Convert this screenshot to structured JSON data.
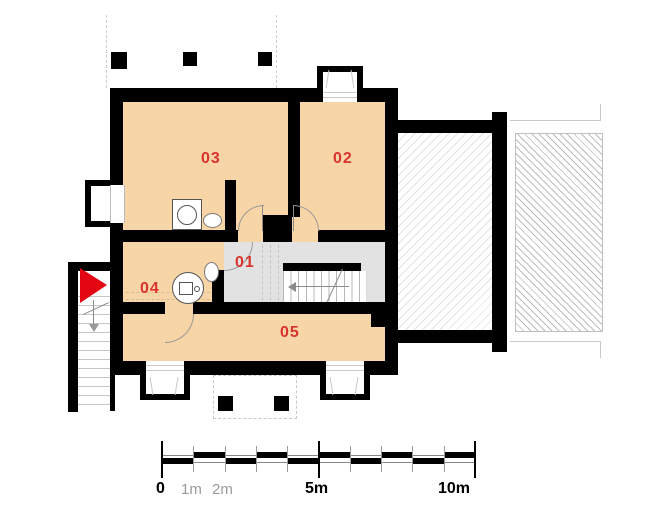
{
  "plan": {
    "kind": "architectural-floor-plan",
    "rooms": [
      {
        "id": "01",
        "label": "01",
        "note": "hall-with-stairs"
      },
      {
        "id": "02",
        "label": "02"
      },
      {
        "id": "03",
        "label": "03"
      },
      {
        "id": "04",
        "label": "04"
      },
      {
        "id": "05",
        "label": "05"
      }
    ],
    "fixtures": [
      "washing-machine-icon",
      "sink-icon",
      "toilet-icon",
      "interior-stairs-icon",
      "exterior-stairs-icon",
      "entrance-arrow-icon",
      "chimney-icon",
      "dormer-window-icon",
      "roof-hatch-icon"
    ],
    "colors": {
      "room_fill": "#F8D5A6",
      "hall_fill": "#E2E2E2",
      "wall": "#000000",
      "room_label": "#D8332D",
      "entrance_arrow": "#E30613",
      "hatch_line": "#BDBDBD"
    },
    "scale_bar": {
      "total_meters": 10,
      "labels": [
        {
          "text": "0",
          "emphasis": true
        },
        {
          "text": "1m",
          "emphasis": false
        },
        {
          "text": "2m",
          "emphasis": false
        },
        {
          "text": "5m",
          "emphasis": true
        },
        {
          "text": "10m",
          "emphasis": true
        }
      ]
    }
  }
}
